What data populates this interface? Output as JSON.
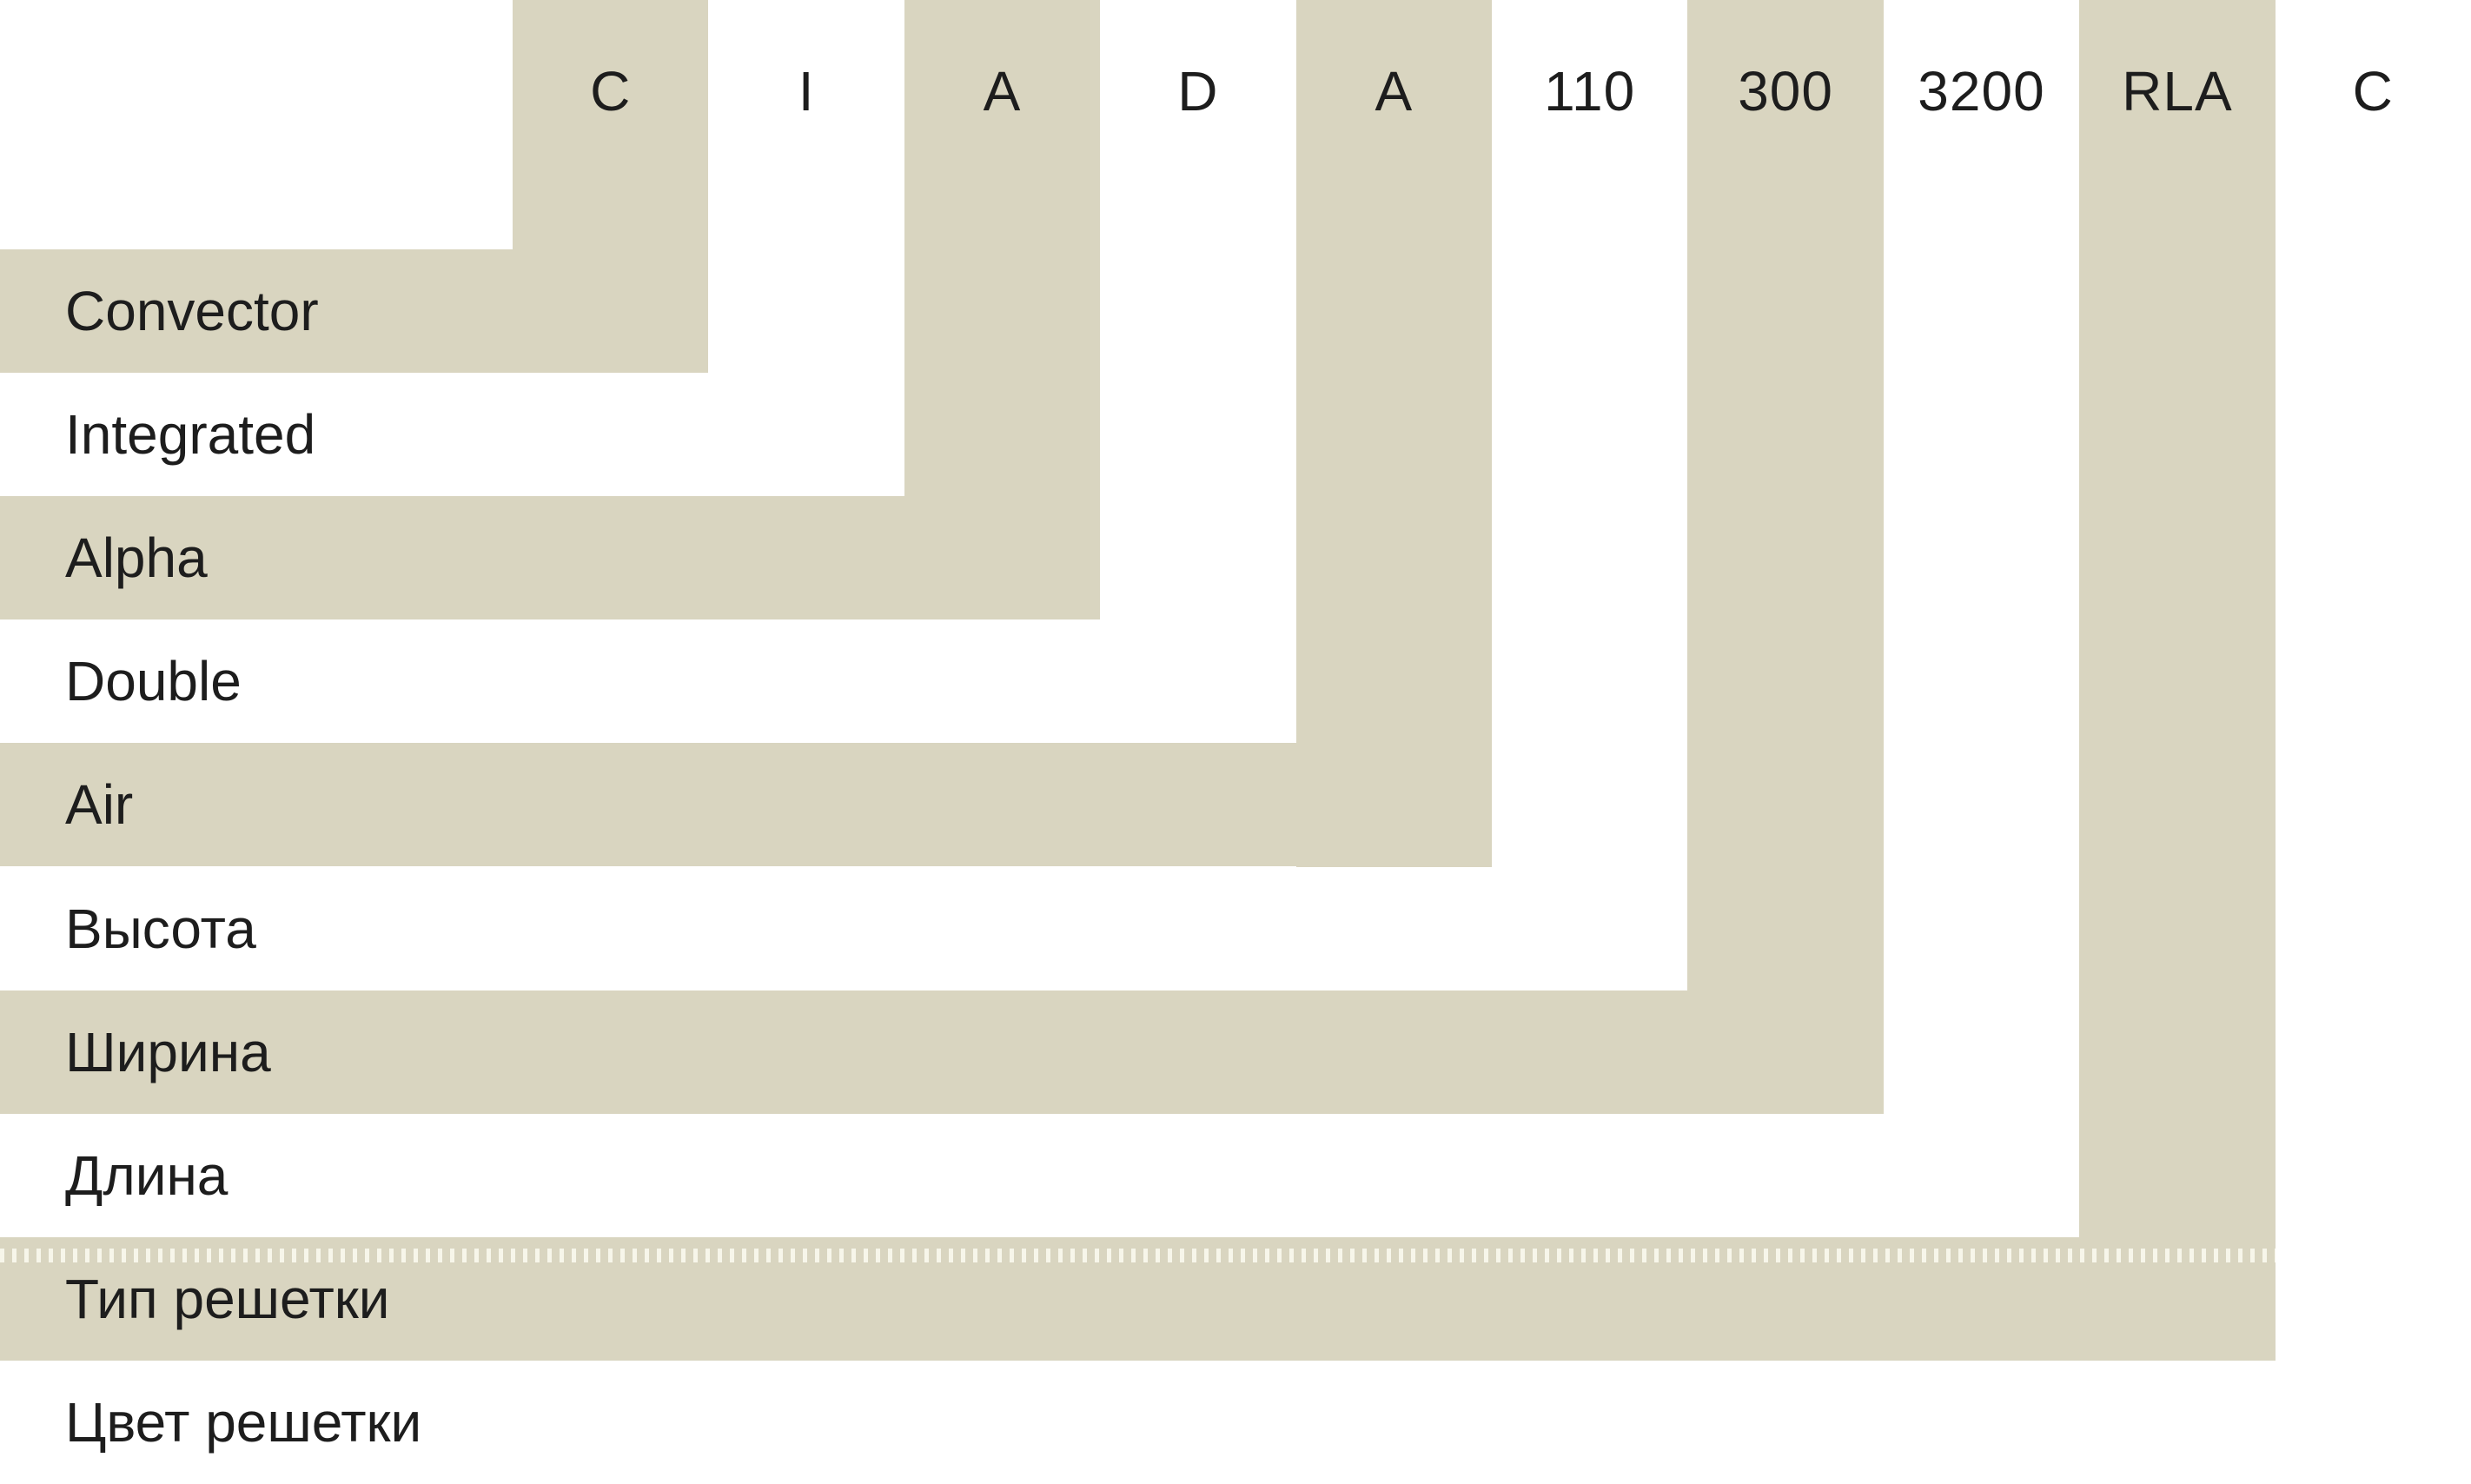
{
  "diagram": {
    "description_rows_language": "en-ru",
    "code_parts": [
      {
        "code": "C",
        "label": "Convector"
      },
      {
        "code": "I",
        "label": "Integrated"
      },
      {
        "code": "A",
        "label": "Alpha"
      },
      {
        "code": "D",
        "label": "Double"
      },
      {
        "code": "A",
        "label": "Air"
      },
      {
        "code": "110",
        "label": "Высота"
      },
      {
        "code": "300",
        "label": "Ширина"
      },
      {
        "code": "3200",
        "label": "Длина"
      },
      {
        "code": "RLA",
        "label": "Тип решетки"
      },
      {
        "code": "C",
        "label": "Цвет решетки"
      }
    ],
    "colors": {
      "accent_beige": "#d9d5c0",
      "background": "#ffffff",
      "text": "#1d1d1d"
    }
  }
}
